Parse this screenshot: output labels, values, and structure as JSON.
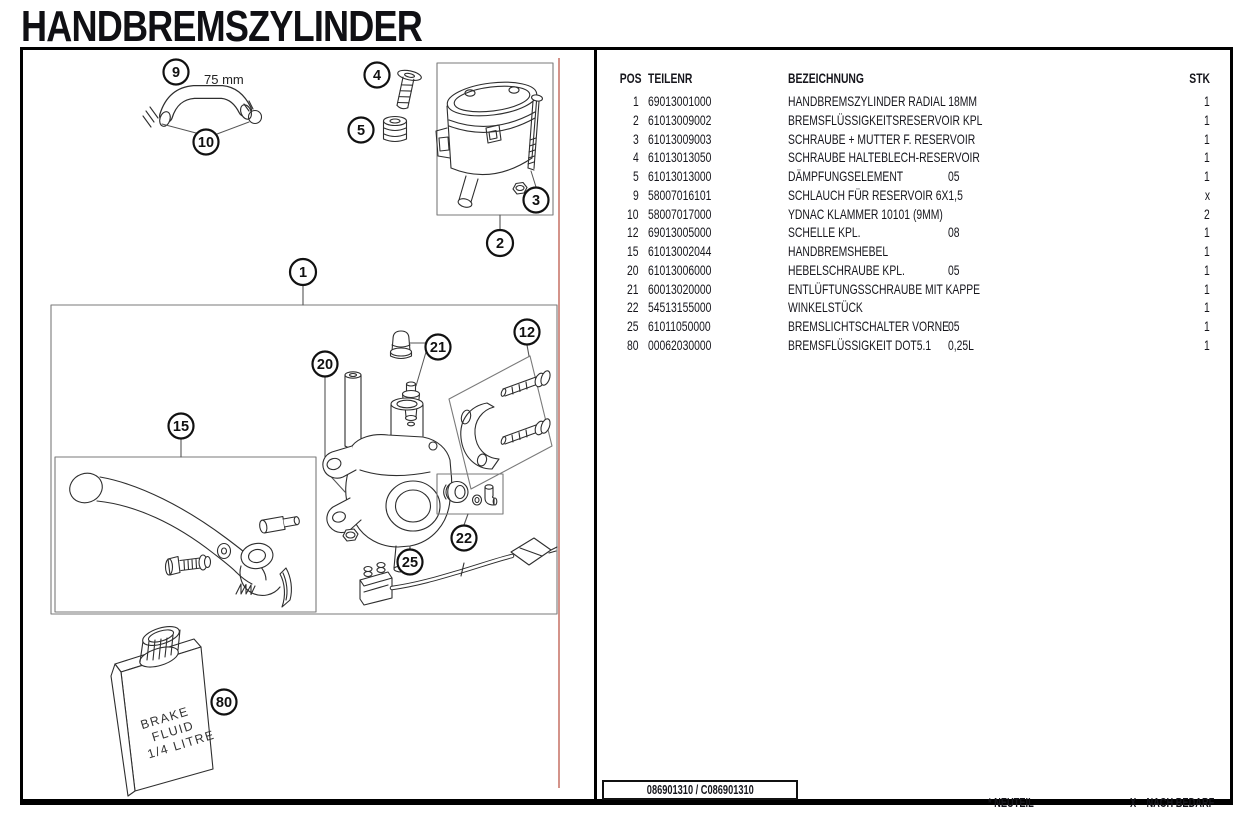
{
  "page": {
    "title": "HANDBREMSZYLINDER"
  },
  "diagram": {
    "dimension_label": "75 mm",
    "bottle": [
      "BRAKE",
      "FLUID",
      "1/4 LITRE"
    ],
    "callouts": {
      "p1": "1",
      "p2": "2",
      "p3": "3",
      "p4": "4",
      "p5": "5",
      "p9": "9",
      "p10": "10",
      "p12": "12",
      "p15": "15",
      "p20": "20",
      "p21": "21",
      "p22": "22",
      "p25": "25",
      "p80": "80"
    },
    "accent_line_color": "#d4938a"
  },
  "table": {
    "headers": {
      "pos": "POS",
      "teilenr": "TEILENR",
      "bezeichnung": "BEZEICHNUNG",
      "stk": "STK"
    },
    "rows": [
      {
        "pos": "1",
        "teilenr": "69013001000",
        "bezeichnung": "HANDBREMSZYLINDER RADIAL 18MM",
        "suffix": "",
        "stk": "1"
      },
      {
        "pos": "2",
        "teilenr": "61013009002",
        "bezeichnung": "BREMSFLÜSSIGKEITSRESERVOIR KPL",
        "suffix": "",
        "stk": "1"
      },
      {
        "pos": "3",
        "teilenr": "61013009003",
        "bezeichnung": "SCHRAUBE + MUTTER F. RESERVOIR",
        "suffix": "",
        "stk": "1"
      },
      {
        "pos": "4",
        "teilenr": "61013013050",
        "bezeichnung": "SCHRAUBE HALTEBLECH-RESERVOIR",
        "suffix": "",
        "stk": "1"
      },
      {
        "pos": "5",
        "teilenr": "61013013000",
        "bezeichnung": "DÄMPFUNGSELEMENT",
        "suffix": "05",
        "stk": "1"
      },
      {
        "pos": "9",
        "teilenr": "58007016101",
        "bezeichnung": "SCHLAUCH FÜR RESERVOIR 6X1,5",
        "suffix": "",
        "stk": "x"
      },
      {
        "pos": "10",
        "teilenr": "58007017000",
        "bezeichnung": "YDNAC KLAMMER 10101 (9MM)",
        "suffix": "",
        "stk": "2"
      },
      {
        "pos": "12",
        "teilenr": "69013005000",
        "bezeichnung": "SCHELLE KPL.",
        "suffix": "08",
        "stk": "1"
      },
      {
        "pos": "15",
        "teilenr": "61013002044",
        "bezeichnung": "HANDBREMSHEBEL",
        "suffix": "",
        "stk": "1"
      },
      {
        "pos": "20",
        "teilenr": "61013006000",
        "bezeichnung": "HEBELSCHRAUBE KPL.",
        "suffix": "05",
        "stk": "1"
      },
      {
        "pos": "21",
        "teilenr": "60013020000",
        "bezeichnung": "ENTLÜFTUNGSSCHRAUBE MIT KAPPE",
        "suffix": "",
        "stk": "1"
      },
      {
        "pos": "22",
        "teilenr": "54513155000",
        "bezeichnung": "WINKELSTÜCK",
        "suffix": "",
        "stk": "1"
      },
      {
        "pos": "25",
        "teilenr": "61011050000",
        "bezeichnung": "BREMSLICHTSCHALTER VORNE",
        "suffix": "05",
        "stk": "1"
      },
      {
        "pos": "80",
        "teilenr": "00062030000",
        "bezeichnung": "BREMSFLÜSSIGKEIT DOT5.1",
        "suffix": "0,25L",
        "stk": "1"
      }
    ]
  },
  "footer": {
    "doc_number": "086901310 / C086901310",
    "neuteil": "* NEUTEIL",
    "nach_bedarf": "X    NACH BEDARF"
  }
}
